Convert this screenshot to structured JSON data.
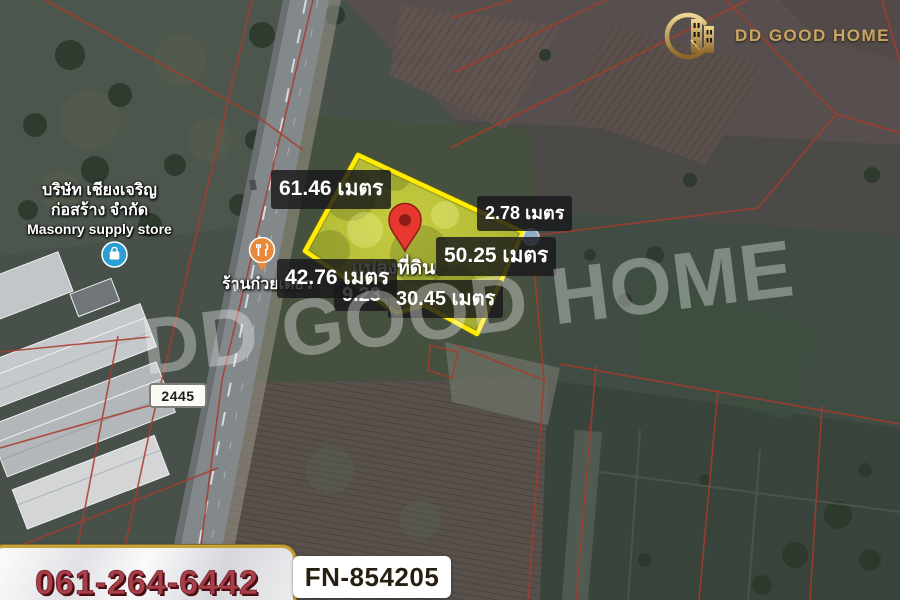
{
  "brand": {
    "name": "DD GOOD HOME",
    "watermark": "DD GOOD HOME",
    "gold_color": "#c9a565"
  },
  "contact": {
    "phone": "061-264-6442",
    "listing_code": "FN-854205",
    "phone_color": "#a83e47"
  },
  "map": {
    "road_number": "2445",
    "plot": {
      "label": "แปลงที่ดิน",
      "outline_color": "#ffec00",
      "pin_color": "#e6382f",
      "measurements": [
        {
          "label": "61.46 เมตร"
        },
        {
          "label": "2.78 เมตร"
        },
        {
          "label": "50.25 เมตร"
        },
        {
          "label": "42.76 เมตร"
        },
        {
          "label": "9.23"
        },
        {
          "label": "30.45 เมตร"
        }
      ]
    },
    "places": [
      {
        "line1": "บริษัท เชียงเจริญ",
        "line2": "ก่อสร้าง จำกัด",
        "category": "Masonry supply store",
        "icon": "store"
      },
      {
        "name": "ร้านก๋วยเตี๋ยว",
        "icon": "restaurant"
      }
    ]
  }
}
